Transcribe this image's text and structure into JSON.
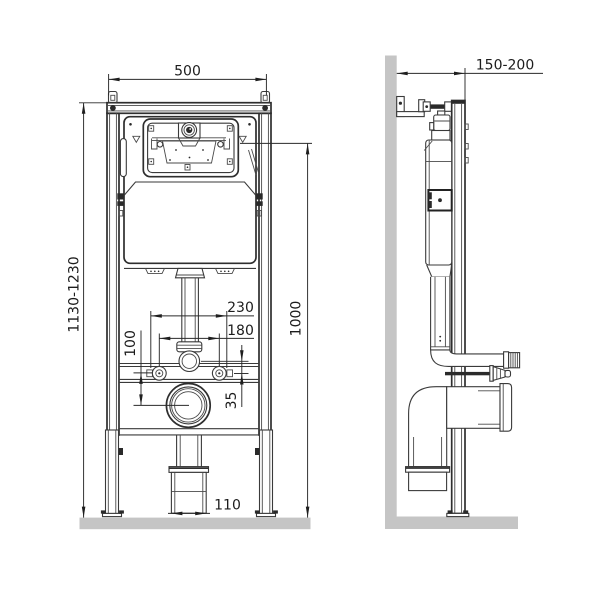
{
  "drawing": {
    "front_view": {
      "frame_width_mm": "500",
      "installation_height_mm": "1130-1230",
      "flush_panel_height_mm": "1000",
      "fixing_span_outer_mm": "230",
      "fixing_span_inner_mm": "180",
      "drain_offset_mm": "100",
      "flush_to_fixing_mm": "35",
      "drain_diameter_mm": "110"
    },
    "side_view": {
      "frame_depth_mm": "150-200"
    },
    "colors": {
      "line": "#3a3a3a",
      "dark": "#2a2a2a",
      "surface": "#c5c5c5",
      "background": "#ffffff"
    }
  }
}
